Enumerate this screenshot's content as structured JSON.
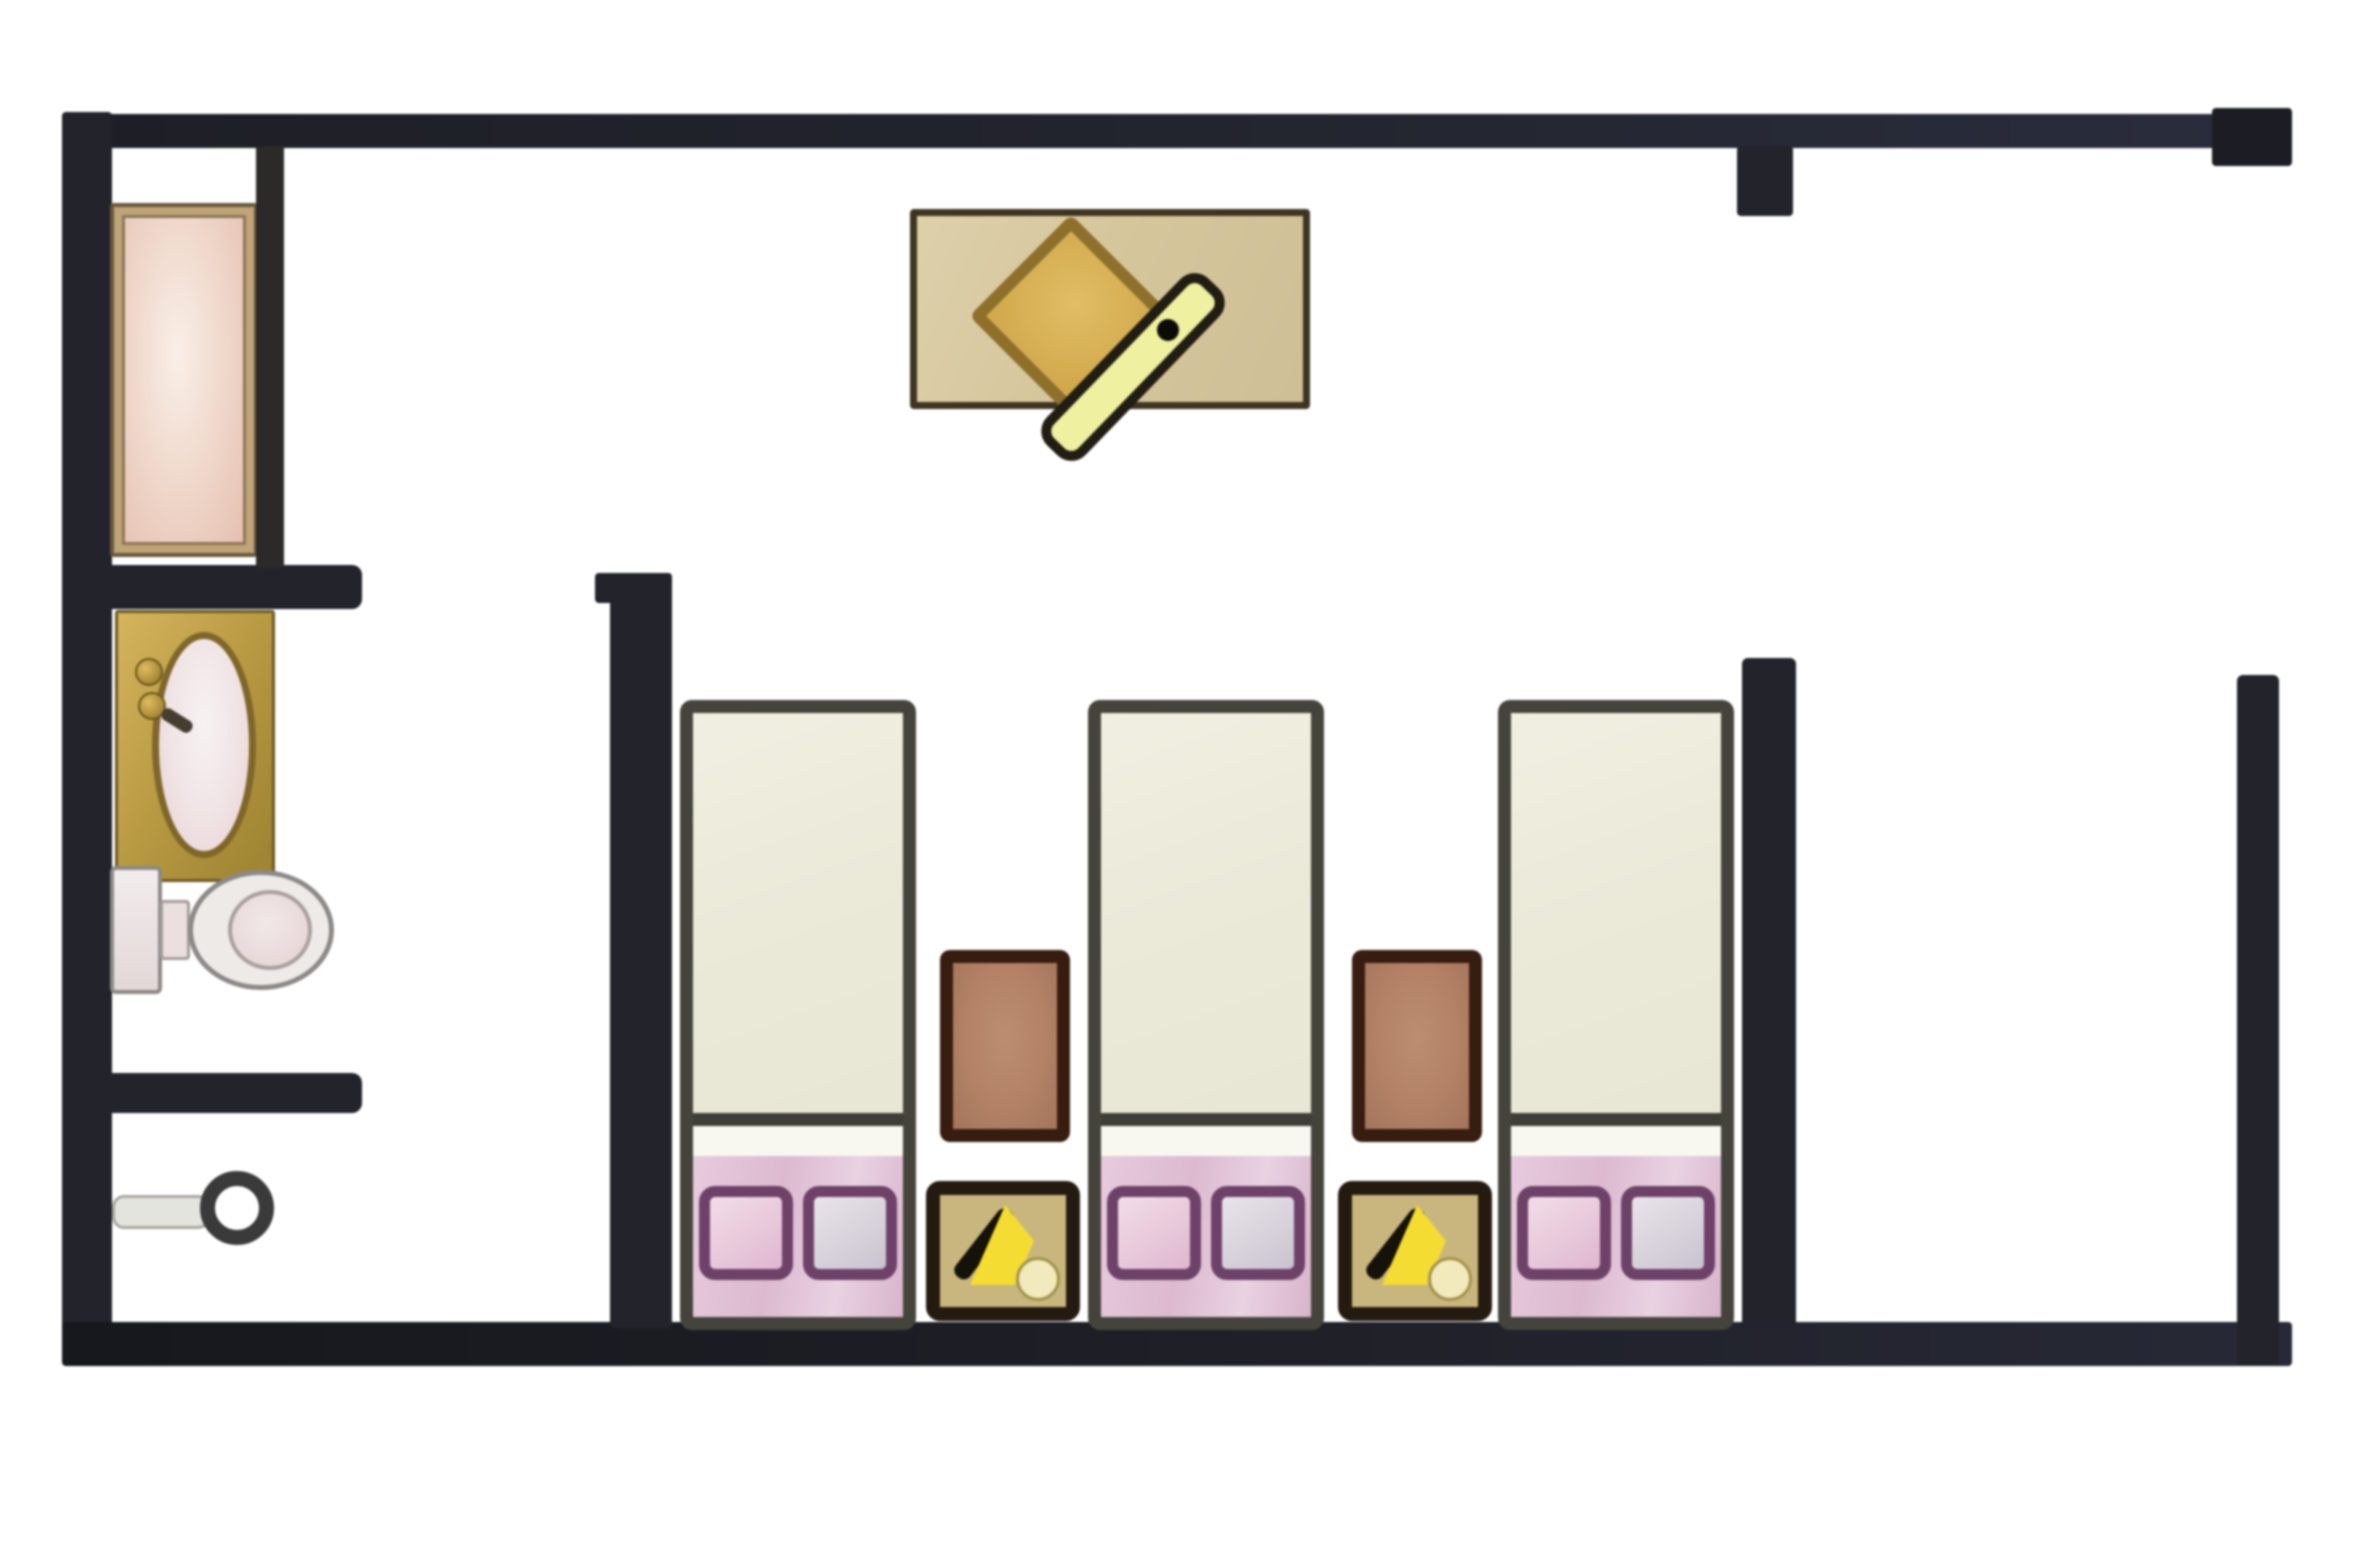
{
  "fixtures": {
    "wall": "wall",
    "bathtub": "bathtub",
    "shower_screen": "shower screen",
    "sink": "sink vanity",
    "faucet": "faucet",
    "toilet": "toilet",
    "door_knob": "door knob",
    "table_mat": "table mat",
    "table": "rotated square table",
    "chair": "chair bench",
    "bed": "single bed",
    "pillow": "pillow",
    "rug": "bedside rug",
    "side_table": "lamp side table",
    "lamp": "lamp"
  },
  "counts": {
    "beds": 3,
    "pillows": 6,
    "rugs": 2,
    "side_tables": 2,
    "bathroom_fixtures": 3
  },
  "colors": {
    "background": "#ffffff",
    "wall": "#22232b",
    "wall_navy_tint": "#2a2d3d",
    "bed_border": "#44443c",
    "bed_fill": "#edecdd",
    "pillow_zone": "#e2c2d7",
    "pillow_outline": "#6e4169",
    "rug_fill": "#b28166",
    "rug_border": "#371c10",
    "side_table_fill": "#c8b67e",
    "lamp_yellow": "#f4dc33",
    "table_mat": "#d9caa2",
    "table_diamond": "#d9b156",
    "chair_bar": "#eff0a0",
    "tub_fill": "#eed3c5",
    "tub_border": "#bfa477",
    "counter_gold": "#c9a94e",
    "toilet_gray": "#edeae8"
  }
}
